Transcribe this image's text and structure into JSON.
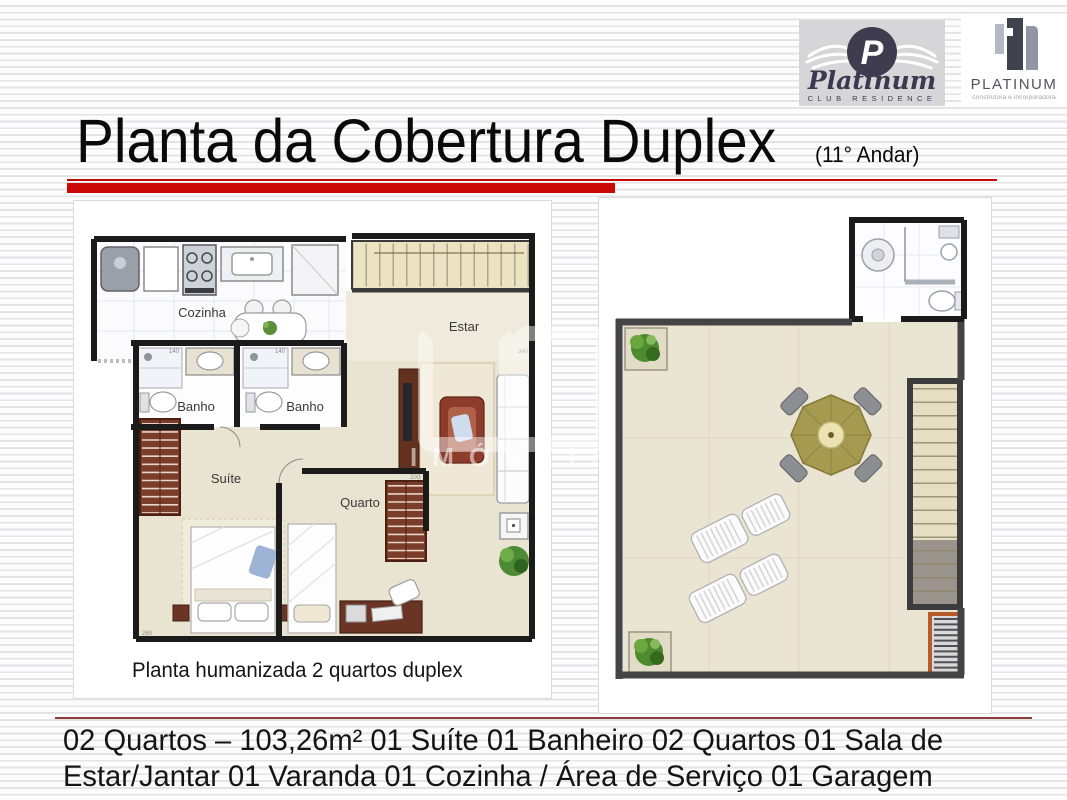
{
  "slide": {
    "title": "Planta da Cobertura Duplex",
    "title_suffix": "(11° Andar)",
    "accent_color": "#cc0707",
    "footer_rule_color": "#8e3a3a"
  },
  "logos": {
    "club": {
      "monogram": "P",
      "name": "Platinum",
      "subtitle": "CLUB RESIDENCE"
    },
    "builder": {
      "name": "PLATINUM",
      "subtitle": "construtora e incorporadora"
    }
  },
  "left_plan": {
    "labels": {
      "kitchen": "Cozinha",
      "living": "Estar",
      "bath1": "Banho",
      "bath2": "Banho",
      "suite": "Suíte",
      "bedroom": "Quarto"
    },
    "dims": {
      "bath": "140",
      "living": "340",
      "bedroom": "200",
      "suite": "260"
    },
    "caption": "Planta humanizada 2 quartos duplex"
  },
  "watermark": {
    "text": "IMÓVEIS"
  },
  "footer": {
    "line1": "02 Quartos – 103,26m² 01 Suíte 01 Banheiro 02 Quartos 01 Sala de",
    "line2": "Estar/Jantar 01 Varanda 01 Cozinha / Área de Serviço 01 Garagem"
  }
}
